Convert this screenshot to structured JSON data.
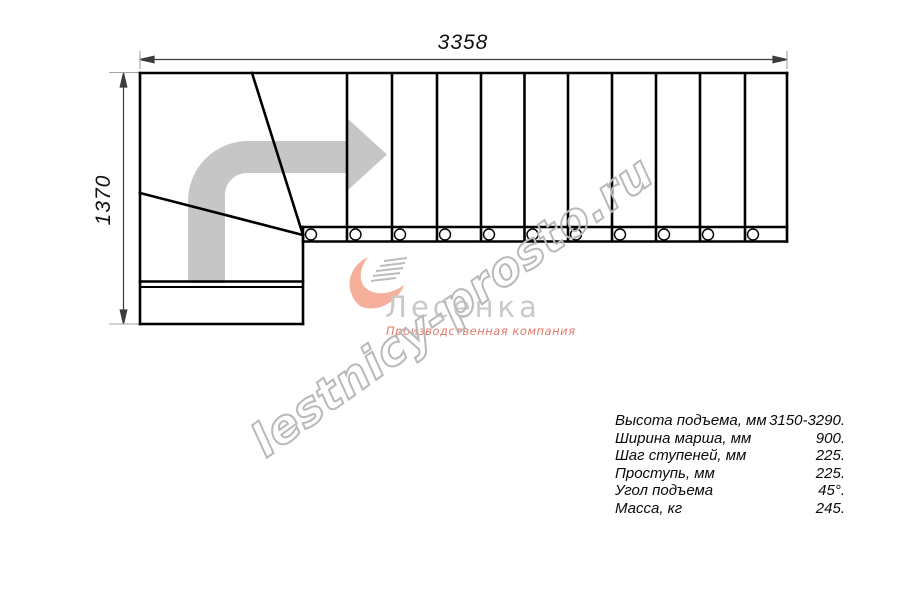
{
  "drawing": {
    "type": "staircase-plan-top-view",
    "dim_width_label": "3358",
    "dim_height_label": "1370"
  },
  "watermark": {
    "text": "lestnicy-prosto.ru"
  },
  "logo": {
    "name": "Лесенка",
    "tagline": "Производственная компания"
  },
  "specs": {
    "rows": [
      {
        "label": "Высота подъема, мм",
        "value": "3150-3290."
      },
      {
        "label": "Ширина марша, мм",
        "value": "900."
      },
      {
        "label": "Шаг ступеней, мм",
        "value": "225."
      },
      {
        "label": "Проступь, мм",
        "value": "225."
      },
      {
        "label": "Угол подъема",
        "value": "45°."
      },
      {
        "label": "Масса, кг",
        "value": "245."
      }
    ]
  },
  "colors": {
    "plan_line": "#000000",
    "dimension_line": "#3c3c3c",
    "extension_line": "#a3a3a3",
    "direction_arrow": "#c6c6c6",
    "watermark": "#b9b9b9",
    "logo_gray": "#c9c9c9",
    "logo_accent": "#f5a68f",
    "tagline": "#e4796b"
  }
}
